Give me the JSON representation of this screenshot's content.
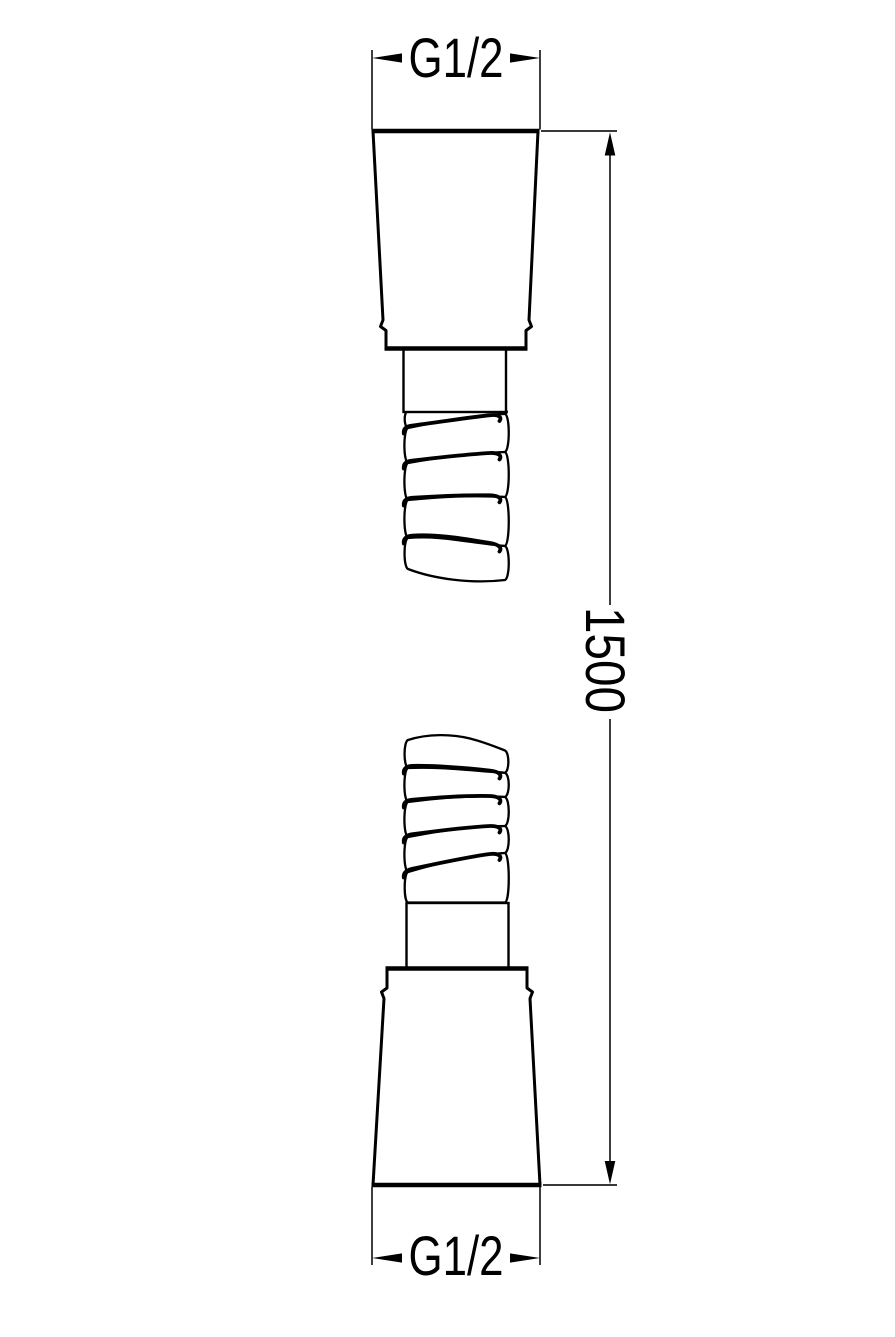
{
  "style": {
    "background_color": "#ffffff",
    "line_color": "#000000",
    "dimension_line_color": "#1c1c1c"
  },
  "drawing": {
    "top_dimension": {
      "label": "G1/2"
    },
    "bottom_dimension": {
      "label": "G1/2"
    },
    "length_dimension": {
      "label": "1500"
    }
  }
}
